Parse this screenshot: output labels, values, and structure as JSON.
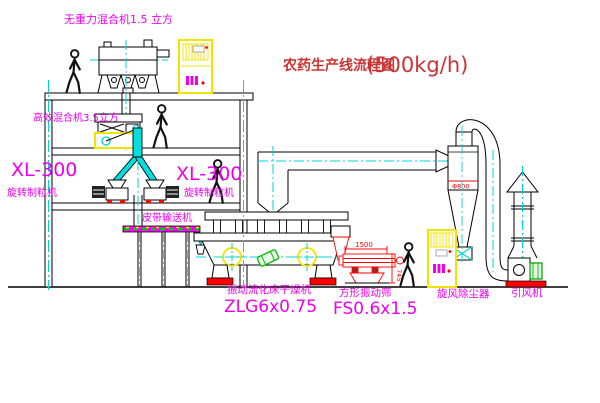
{
  "title": {
    "name": "农药生产线流程图",
    "capacity": "(500kg/h)"
  },
  "equipment": {
    "gravity_mixer": {
      "label": "无重力混合机1.5 立方"
    },
    "high_eff_mixer": {
      "label": "高效混合机3.5立方"
    },
    "granulator_left": {
      "model": "XL-300",
      "name": "旋转制粒机"
    },
    "granulator_right": {
      "model": "XL-300",
      "name": "旋转制粒机"
    },
    "belt_conveyor": {
      "label": "皮带输送机"
    },
    "fluid_bed_dryer": {
      "name": "振动流化床干燥机",
      "model": "ZLG6x0.75"
    },
    "vibrating_sieve": {
      "name": "方形振动筛",
      "model": "FS0.6x1.5"
    },
    "cyclone": {
      "label": "旋风除尘器",
      "diameter": "Φ800"
    },
    "fan": {
      "label": "引风机"
    }
  },
  "dimensions": {
    "sieve_width": "1500",
    "sieve_height": "745"
  },
  "colors": {
    "line": "#000000",
    "label_magenta": "#ee00ee",
    "title_red": "#cc3333",
    "centerline_cyan": "#00d5d5",
    "highlight_yellow": "#ffff00",
    "alert_red": "#ff0000",
    "machine_green": "#00bb00"
  }
}
